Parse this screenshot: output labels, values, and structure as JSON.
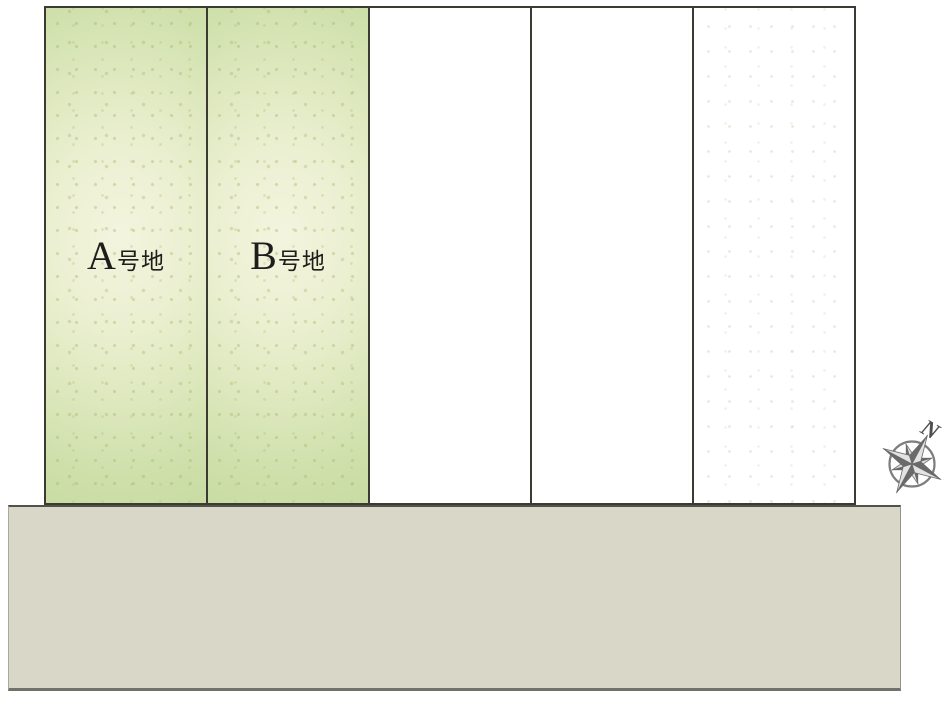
{
  "diagram": {
    "kind": "real-estate-lot-layout-plan",
    "background": "#ffffff",
    "border_color": "#3c3b33",
    "lots": [
      {
        "id": "A",
        "label": "A号地",
        "letter": "A",
        "suffix": "号地",
        "highlighted": true,
        "fill": "#dfe9c0"
      },
      {
        "id": "B",
        "label": "B号地",
        "letter": "B",
        "suffix": "号地",
        "highlighted": true,
        "fill": "#dfe9c0"
      },
      {
        "id": "C",
        "label": "",
        "highlighted": false,
        "fill": "#ffffff"
      },
      {
        "id": "D",
        "label": "",
        "highlighted": false,
        "fill": "#ffffff"
      },
      {
        "id": "E",
        "label": "",
        "highlighted": false,
        "fill": "#ffffff"
      }
    ],
    "road": {
      "fill": "#d9d8c8",
      "edge_color": "#73726a"
    },
    "compass": {
      "north_label": "N",
      "ring_color": "#7e7e7e",
      "dark_color": "#6a6a6a",
      "light_color": "#e3e3e3"
    },
    "label_text_color": "#1d1d1b"
  }
}
